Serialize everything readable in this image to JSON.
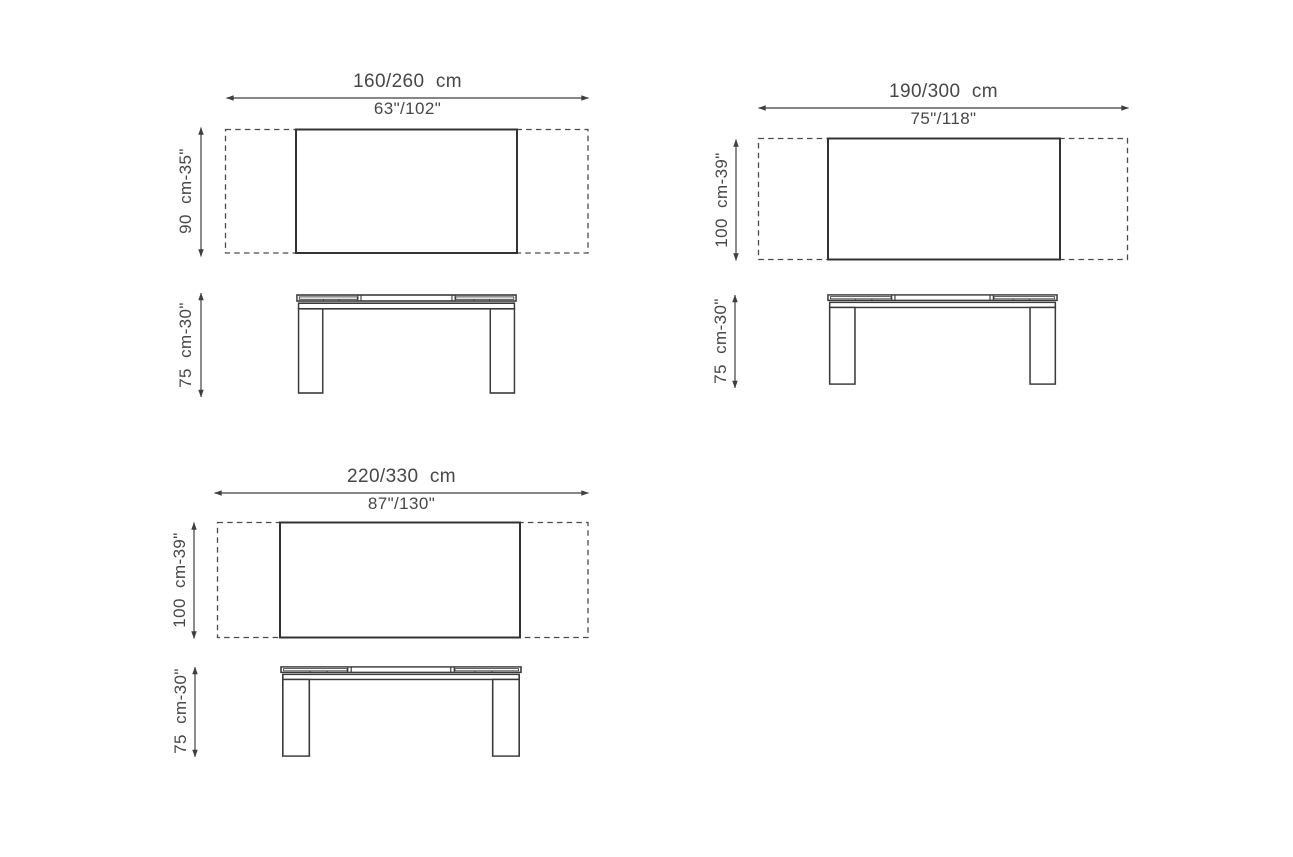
{
  "page": {
    "background_color": "#ffffff",
    "line_color": "#3a3a3a",
    "dash_color": "#4a4a4a",
    "text_color": "#474747",
    "content": "Three technical dimension drawings of an extendable rectangular table: top view (closed/extended width) and front elevation (height)"
  },
  "diagrams": [
    {
      "id": "table-160-260",
      "width_cm": "160/260  cm",
      "width_in": "63\"/102\"",
      "depth_label": "90  cm-35\"",
      "height_label": "75  cm-30\""
    },
    {
      "id": "table-190-300",
      "width_cm": "190/300  cm",
      "width_in": "75\"/118\"",
      "depth_label": "100  cm-39\"",
      "height_label": "75  cm-30\""
    },
    {
      "id": "table-220-330",
      "width_cm": "220/330  cm",
      "width_in": "87\"/130\"",
      "depth_label": "100  cm-39\"",
      "height_label": "75  cm-30\""
    }
  ]
}
